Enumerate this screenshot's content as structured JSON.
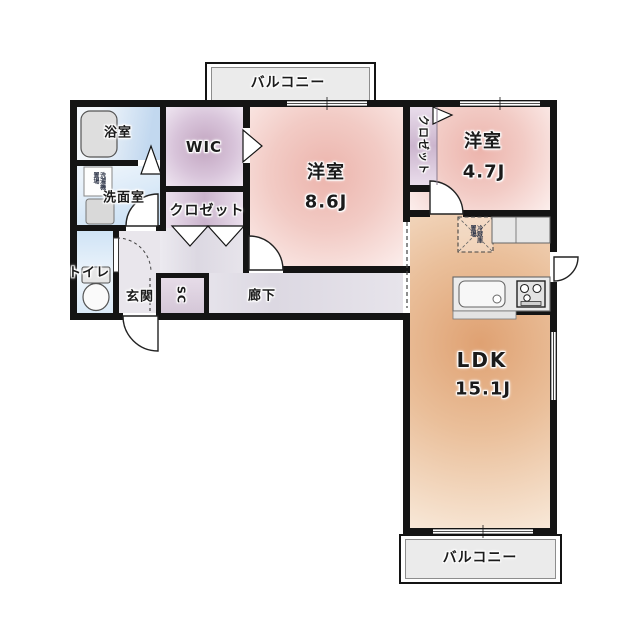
{
  "balconies": {
    "top": "バルコニー",
    "bottom": "バルコニー"
  },
  "rooms": {
    "bath": {
      "label": "浴室"
    },
    "washroom": {
      "label": "洗面室"
    },
    "wic": {
      "label": "WIC"
    },
    "bedroom1": {
      "label": "洋室",
      "size": "8.6J"
    },
    "bedroom2": {
      "label": "洋室",
      "size": "4.7J"
    },
    "closet_hall": {
      "label": "クロゼット"
    },
    "closet_bed2": {
      "label": "クロゼット"
    },
    "toilet": {
      "label": "トイレ"
    },
    "entrance": {
      "label": "玄関"
    },
    "shoe_closet": {
      "label": "SC"
    },
    "hallway": {
      "label": "廊下"
    },
    "ldk": {
      "label": "LDK",
      "size": "15.1J"
    }
  },
  "fixtures": {
    "refrigerator_space": "冷蔵庫\n置場",
    "washer_space": "洗濯機\n置場"
  },
  "colors": {
    "wall": "#141414",
    "bedroom_fill": "#f2cbc5",
    "ldk_fill": "#eabf9a",
    "closet_fill": "#cbb4cd",
    "hallway_fill": "#dcd8e2",
    "bath_fill": "#c2d8ef",
    "balcony_fill": "#ebebeb"
  }
}
